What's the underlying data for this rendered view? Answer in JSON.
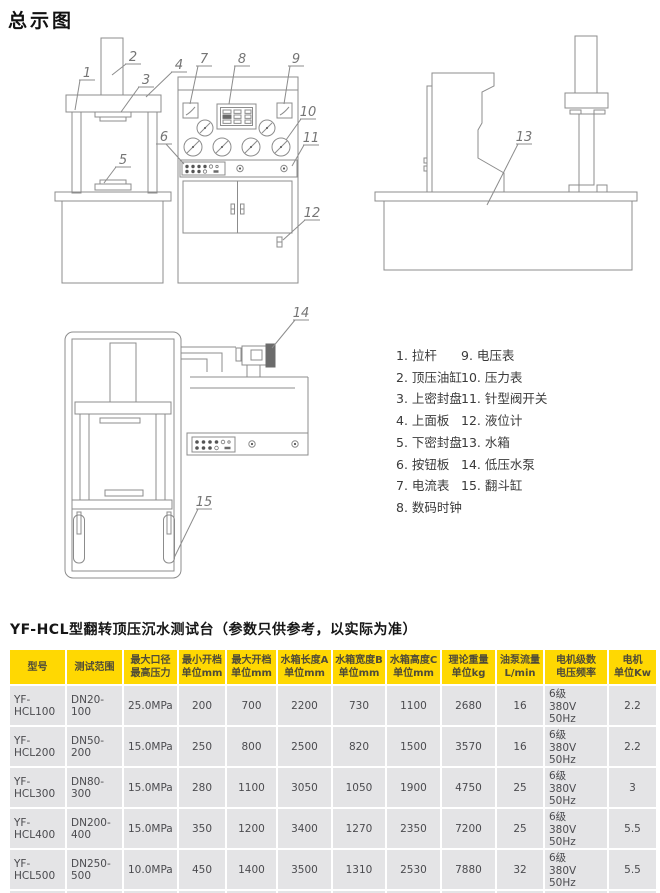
{
  "page_title": "总示图",
  "section_heading": "YF-HCL型翻转顶压沉水测试台（参数只供参考，以实际为准）",
  "drawing": {
    "front_callouts": [
      "1",
      "2",
      "3",
      "4",
      "5",
      "6",
      "7",
      "8",
      "9",
      "10",
      "11",
      "12"
    ],
    "side_callout": "13",
    "pump_callout": "14",
    "tip_callout": "15"
  },
  "parts_list": {
    "column1": [
      "1. 拉杆",
      "2. 顶压油缸",
      "3. 上密封盘",
      "4. 上面板",
      "5. 下密封盘",
      "6. 按钮板",
      "7. 电流表",
      "8. 数码时钟"
    ],
    "column2": [
      "9. 电压表",
      "10. 压力表",
      "11. 针型阀开关",
      "12. 液位计",
      "13. 水箱",
      "14. 低压水泵",
      "15. 翻斗缸"
    ]
  },
  "spec_table": {
    "headers": [
      "型号",
      "测试范围",
      "最大口径\n最高压力",
      "最小开档\n单位mm",
      "最大开档\n单位mm",
      "水箱长度A\n单位mm",
      "水箱宽度B\n单位mm",
      "水箱高度C\n单位mm",
      "理论重量\n单位kg",
      "油泵流量\nL/min",
      "电机级数\n电压频率",
      "电机\n单位Kw"
    ],
    "rows": [
      [
        "YF-HCL100",
        "DN20-100",
        "25.0MPa",
        "200",
        "700",
        "2200",
        "730",
        "1100",
        "2680",
        "16",
        "6级\n380V 50Hz",
        "2.2"
      ],
      [
        "YF-HCL200",
        "DN50-200",
        "15.0MPa",
        "250",
        "800",
        "2500",
        "820",
        "1500",
        "3570",
        "16",
        "6级\n380V 50Hz",
        "2.2"
      ],
      [
        "YF-HCL300",
        "DN80-300",
        "15.0MPa",
        "280",
        "1100",
        "3050",
        "1050",
        "1900",
        "4750",
        "25",
        "6级\n380V 50Hz",
        "3"
      ],
      [
        "YF-HCL400",
        "DN200-400",
        "15.0MPa",
        "350",
        "1200",
        "3400",
        "1270",
        "2350",
        "7200",
        "25",
        "6级\n380V 50Hz",
        "5.5"
      ],
      [
        "YF-HCL500",
        "DN250-500",
        "10.0MPa",
        "450",
        "1400",
        "3500",
        "1310",
        "2530",
        "7880",
        "32",
        "6级\n380V 50Hz",
        "5.5"
      ],
      [
        "YF-HCL600",
        "DN300-600",
        "10.0MPa",
        "460",
        "1500",
        "3600",
        "1380",
        "2750",
        "8880",
        "32",
        "6级\n380V 50Hz",
        "7.5"
      ]
    ]
  },
  "colors": {
    "table_header_bg": "#ffd802",
    "table_header_text": "#4f4b38",
    "table_cell_bg": "#e4e4e6",
    "table_cell_text": "#4b4b4f",
    "drawing_stroke": "#8c8c8c"
  }
}
